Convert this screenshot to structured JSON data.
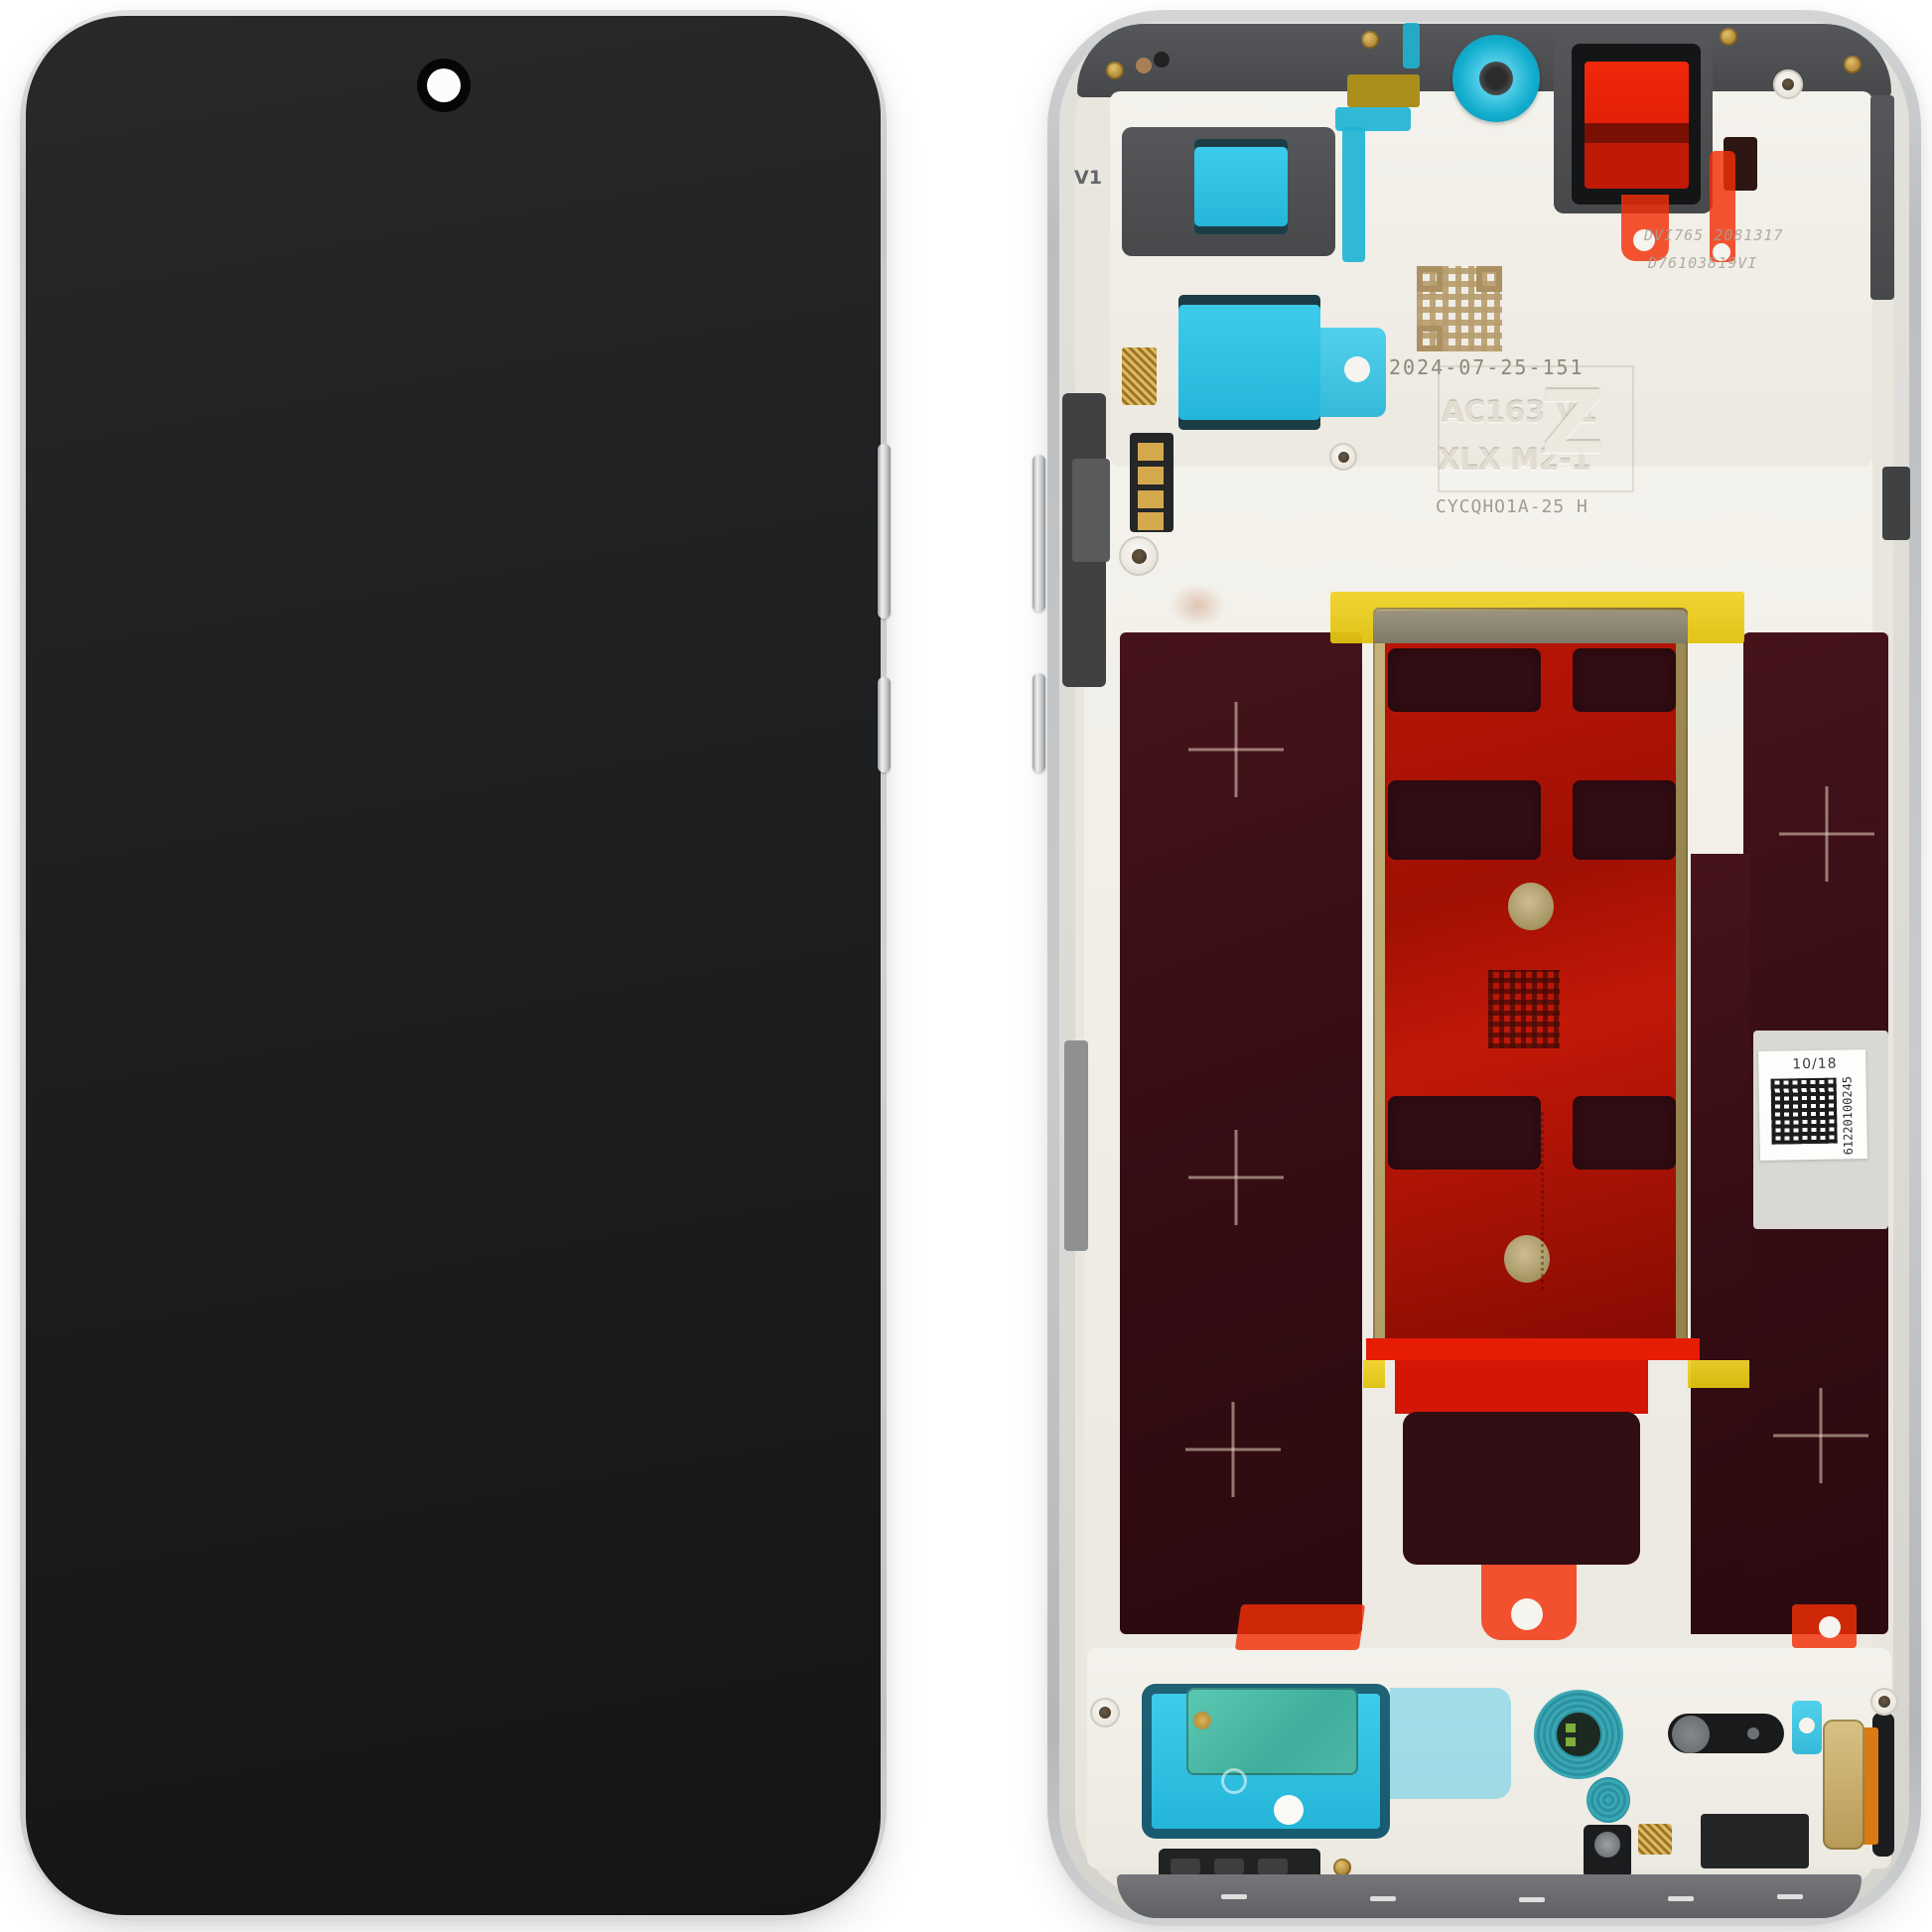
{
  "meta": {
    "subject": "Smartphone display assembly spare part, front view and rear chassis view",
    "background_color": "#ffffff"
  },
  "front_view": {
    "screen_color": "#1d1e20",
    "frame_color": "#c9cbcd",
    "camera_hole": "punch-hole-camera"
  },
  "back_view": {
    "etched": {
      "date_code": "2024-07-25-151",
      "model_line1": "AC163 V1",
      "model_line2": "XLX M2-1",
      "code_line": "CYCQHO1A-25 H",
      "logo": "Z",
      "frame_mark": "V1",
      "laser_line1": "DVI765 2081317",
      "laser_line2": "D76103819VI"
    },
    "sticker": {
      "top_label": "10/18",
      "serial_vertical": "61220100245"
    },
    "colors": {
      "adhesive_cyan": "#29bfe4",
      "camera_ring_teal": "#13aecf",
      "flash_red": "#e8220c",
      "battery_red": "#b51407",
      "graphite_maroon": "#330d14",
      "kapton_yellow": "#e5c714",
      "brass_gold": "#b3a06b",
      "chassis_cream": "#efece4"
    }
  }
}
